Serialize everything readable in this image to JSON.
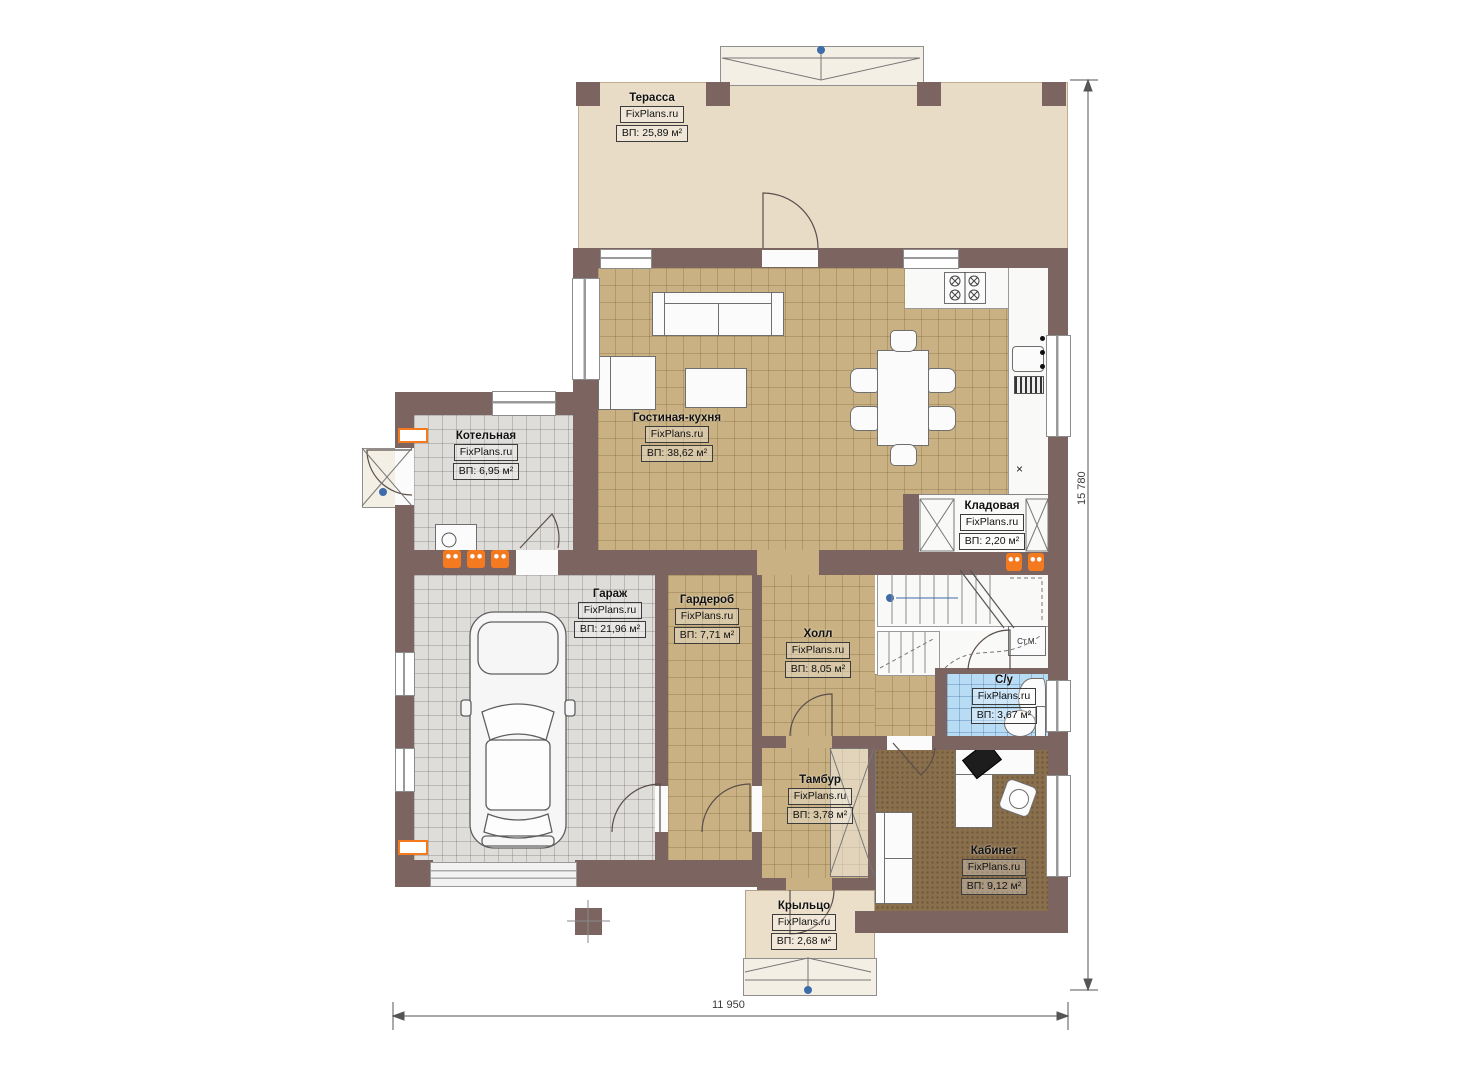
{
  "plan": {
    "type": "floor-plan",
    "brand": "FixPlans.ru"
  },
  "rooms": [
    {
      "id": "terrace",
      "name": "Терасса",
      "brand": "FixPlans.ru",
      "area": "ВП: 25,89 м²"
    },
    {
      "id": "living_kitchen",
      "name": "Гостиная-кухня",
      "brand": "FixPlans.ru",
      "area": "ВП: 38,62 м²"
    },
    {
      "id": "boiler",
      "name": "Котельная",
      "brand": "FixPlans.ru",
      "area": "ВП: 6,95 м²"
    },
    {
      "id": "storage",
      "name": "Кладовая",
      "brand": "FixPlans.ru",
      "area": "ВП: 2,20 м²"
    },
    {
      "id": "garage",
      "name": "Гараж",
      "brand": "FixPlans.ru",
      "area": "ВП: 21,96 м²"
    },
    {
      "id": "wardrobe",
      "name": "Гардероб",
      "brand": "FixPlans.ru",
      "area": "ВП: 7,71 м²"
    },
    {
      "id": "hall",
      "name": "Холл",
      "brand": "FixPlans.ru",
      "area": "ВП: 8,05 м²"
    },
    {
      "id": "bathroom",
      "name": "С/у",
      "brand": "FixPlans.ru",
      "area": "ВП: 3,67 м²"
    },
    {
      "id": "vestibule",
      "name": "Тамбур",
      "brand": "FixPlans.ru",
      "area": "ВП: 3,78 м²"
    },
    {
      "id": "office",
      "name": "Кабинет",
      "brand": "FixPlans.ru",
      "area": "ВП: 9,12 м²"
    },
    {
      "id": "porch",
      "name": "Крыльцо",
      "brand": "FixPlans.ru",
      "area": "ВП: 2,68 м²"
    }
  ],
  "annotations": {
    "washing_machine": "Ст.М.",
    "kitchen_mark": "×"
  },
  "dimensions": {
    "horizontal": "11 950",
    "vertical": "15 780"
  },
  "colors": {
    "wall": "#7c6460",
    "terrace_floor": "#e9dcc7",
    "tile_tan": "#c9b183",
    "tile_gray": "#deddda",
    "tile_blue": "#b9dcf5",
    "office_carpet": "#8a6f4c",
    "radiator": "#f47a20",
    "marker_blue": "#3d6ca8"
  }
}
